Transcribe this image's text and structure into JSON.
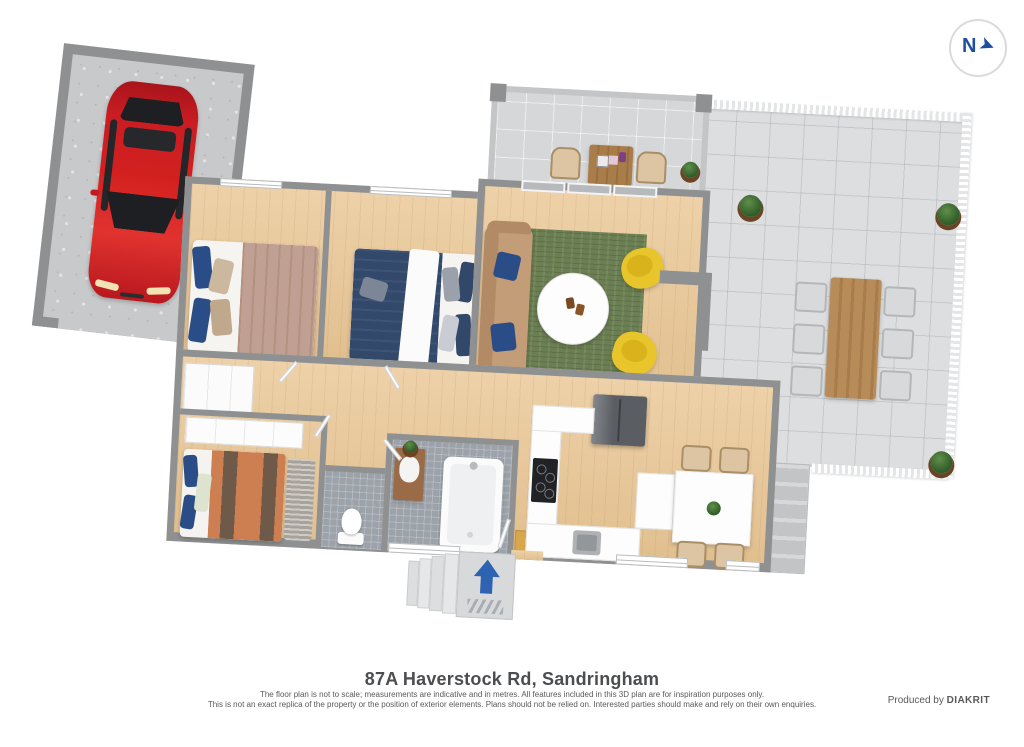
{
  "compass": {
    "letter": "N",
    "arrow_glyph": "➤"
  },
  "footer": {
    "title": "87A Haverstock Rd, Sandringham",
    "disclaimer_line1": "The floor plan is not to scale; measurements are indicative and in metres. All features included in this 3D plan are for inspiration purposes only.",
    "disclaimer_line2": "This is not an exact replica of the property or the position of exterior elements. Plans should not be relied on. Interested parties should make and rely on their own enquiries.",
    "produced_by": "Produced by",
    "producer": "DIAKRIT"
  },
  "floorplan": {
    "type": "3d-floor-plan",
    "entry_arrow_direction": "up",
    "rooms": [
      {
        "name": "garage",
        "contents": [
          "red-car"
        ]
      },
      {
        "name": "bedroom-left",
        "contents": [
          "double-bed-mauve",
          "blue-and-beige-pillows",
          "window"
        ]
      },
      {
        "name": "bedroom-middle",
        "contents": [
          "double-bed-navy",
          "white-throw",
          "window"
        ]
      },
      {
        "name": "living-room",
        "contents": [
          "tan-sofa",
          "green-rug",
          "round-white-coffee-table",
          "two-yellow-armchairs",
          "sliding-glass-doors"
        ]
      },
      {
        "name": "courtyard-patio",
        "contents": [
          "two-timber-armchairs",
          "timber-coffee-table",
          "potted-plant"
        ]
      },
      {
        "name": "terrace",
        "contents": [
          "timber-dining-table",
          "six-outdoor-chairs",
          "three-potted-plants",
          "white-picket-fence",
          "exterior-steps"
        ]
      },
      {
        "name": "kitchen",
        "contents": [
          "fridge",
          "cooktop",
          "sink",
          "white-counters",
          "peninsula"
        ]
      },
      {
        "name": "meals-area",
        "contents": [
          "white-dining-table",
          "four-beige-chairs",
          "table-plant"
        ]
      },
      {
        "name": "bedroom-rear",
        "contents": [
          "double-bed-orange",
          "built-in-robe",
          "shag-rug",
          "blue-pillows"
        ]
      },
      {
        "name": "wc",
        "contents": [
          "toilet",
          "gray-tiles"
        ]
      },
      {
        "name": "bathroom",
        "contents": [
          "timber-vanity",
          "bathtub",
          "gray-tiles"
        ]
      },
      {
        "name": "entry",
        "contents": [
          "porch-steps",
          "blue-direction-arrow",
          "striped-doormat",
          "yellow-inner-mat"
        ]
      }
    ]
  },
  "colors": {
    "wall": "#8e9092",
    "wood_floor": "#eac795",
    "garage_floor": "#c7c9cb",
    "patio_tile": "#dcdee0",
    "bath_tile": "#9ba2a9",
    "car_red": "#d2201f",
    "rug_green": "#6b7f52",
    "armchair_yellow": "#e8c52b",
    "sofa_tan": "#c39c78",
    "bed_mauve": "#c0a092",
    "bed_navy": "#32496c",
    "bed_orange": "#ce7f52",
    "chair_beige": "#ddc5a3",
    "table_wood": "#b78c59",
    "arrow_blue": "#2d63b0",
    "compass_blue": "#1d4f9c",
    "text": "#4c4d4f"
  }
}
